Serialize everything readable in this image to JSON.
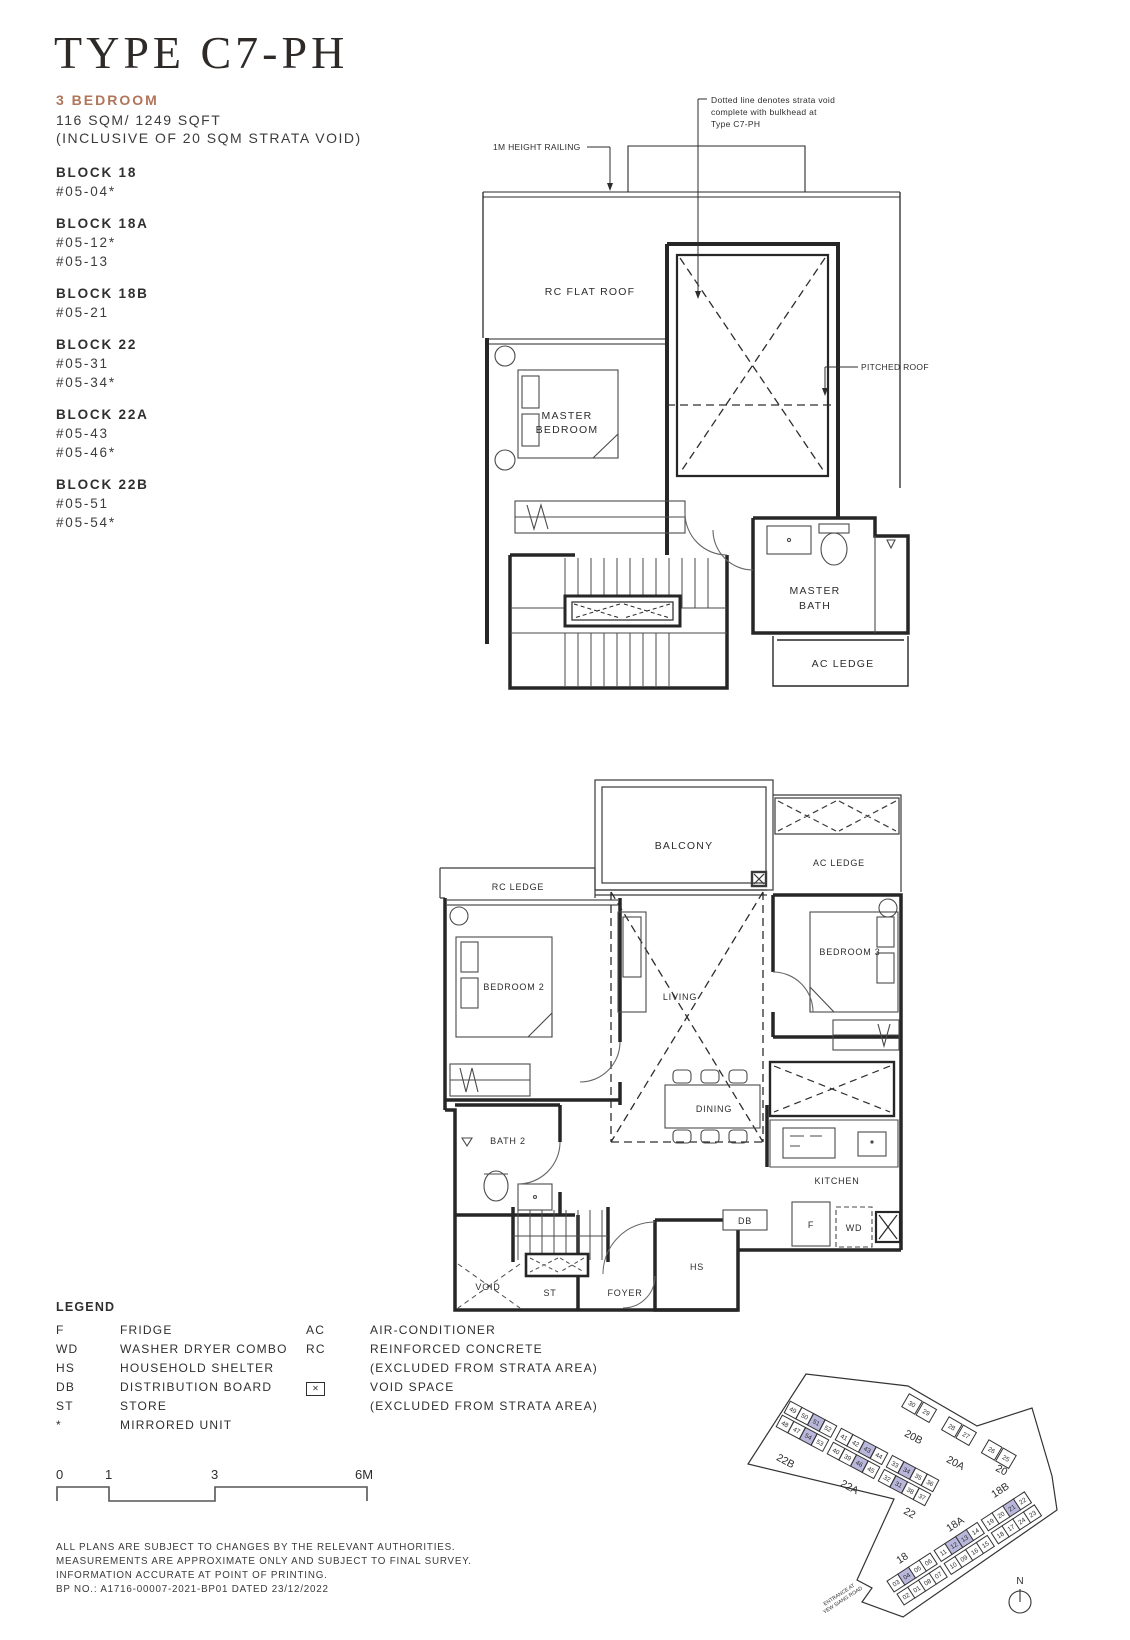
{
  "header": {
    "title": "TYPE C7-PH",
    "unit_type": "3 BEDROOM",
    "area": "116 SQM/ 1249 SQFT",
    "area_note": "(INCLUSIVE OF 20 SQM STRATA VOID)",
    "accent_color": "#b1755a"
  },
  "blocks": [
    {
      "name": "BLOCK 18",
      "units": [
        "#05-04*"
      ]
    },
    {
      "name": "BLOCK 18A",
      "units": [
        "#05-12*",
        "#05-13"
      ]
    },
    {
      "name": "BLOCK 18B",
      "units": [
        "#05-21"
      ]
    },
    {
      "name": "BLOCK 22",
      "units": [
        "#05-31",
        "#05-34*"
      ]
    },
    {
      "name": "BLOCK 22A",
      "units": [
        "#05-43",
        "#05-46*"
      ]
    },
    {
      "name": "BLOCK 22B",
      "units": [
        "#05-51",
        "#05-54*"
      ]
    }
  ],
  "upper_plan": {
    "rooms": {
      "rc_flat_roof": "RC FLAT ROOF",
      "master_bedroom_1": "MASTER",
      "master_bedroom_2": "BEDROOM",
      "master_bath_1": "MASTER",
      "master_bath_2": "BATH",
      "ac_ledge": "AC LEDGE"
    },
    "annotations": {
      "railing": "1M HEIGHT RAILING",
      "strata_1": "Dotted line denotes strata void",
      "strata_2": "complete with bulkhead at",
      "strata_3": "Type C7-PH",
      "pitched_roof": "PITCHED ROOF"
    }
  },
  "lower_plan": {
    "rooms": {
      "balcony": "BALCONY",
      "ac_ledge": "AC LEDGE",
      "rc_ledge": "RC LEDGE",
      "bedroom2": "BEDROOM 2",
      "living": "LIVING",
      "bedroom3": "BEDROOM 3",
      "dining": "DINING",
      "bath2": "BATH 2",
      "kitchen": "KITCHEN",
      "db": "DB",
      "fridge": "F",
      "wd": "WD",
      "foyer": "FOYER",
      "hs": "HS",
      "void": "VOID",
      "st": "ST"
    }
  },
  "legend": {
    "title": "LEGEND",
    "void_symbol": "✕",
    "left": [
      {
        "abbr": "F",
        "label": "FRIDGE"
      },
      {
        "abbr": "WD",
        "label": "WASHER DRYER COMBO"
      },
      {
        "abbr": "HS",
        "label": "HOUSEHOLD SHELTER"
      },
      {
        "abbr": "DB",
        "label": "DISTRIBUTION BOARD"
      },
      {
        "abbr": "ST",
        "label": "STORE"
      },
      {
        "abbr": "*",
        "label": "MIRRORED UNIT"
      }
    ],
    "right": [
      {
        "abbr": "AC",
        "label": "AIR-CONDITIONER"
      },
      {
        "abbr": "RC",
        "label": "REINFORCED CONCRETE"
      },
      {
        "abbr": "",
        "label": "(EXCLUDED FROM STRATA AREA)"
      },
      {
        "abbr": "",
        "label": "VOID SPACE"
      },
      {
        "abbr": "",
        "label": "(EXCLUDED FROM STRATA AREA)"
      }
    ]
  },
  "scale": {
    "ticks": [
      "0",
      "1",
      "3",
      "6M"
    ]
  },
  "notes": [
    "ALL PLANS ARE SUBJECT TO CHANGES BY THE RELEVANT AUTHORITIES.",
    "MEASUREMENTS ARE APPROXIMATE ONLY AND SUBJECT TO FINAL SURVEY.",
    "INFORMATION ACCURATE AT POINT OF PRINTING.",
    "BP NO.: A1716-00007-2021-BP01 DATED 23/12/2022"
  ],
  "site_plan": {
    "north_label": "N",
    "entrance_line1": "ENTRANCE AT",
    "entrance_line2": "YEW SIANG ROAD",
    "highlight_color": "#b9b7db",
    "highlighted_units": [
      "04",
      "12",
      "13",
      "21",
      "31",
      "34",
      "43",
      "46",
      "51",
      "54"
    ],
    "strips": [
      {
        "angle": 28,
        "x": 93,
        "y": 80,
        "step": 13.2,
        "size": 13,
        "row_dx": -8,
        "row_dy": 14,
        "gaps": [
          3,
          7
        ],
        "gap": 5,
        "rows": [
          [
            {
              "n": "49"
            },
            {
              "n": "50"
            },
            {
              "n": "51",
              "h": true
            },
            {
              "n": "52"
            },
            {
              "n": "41"
            },
            {
              "n": "42"
            },
            {
              "n": "43",
              "h": true
            },
            {
              "n": "44"
            },
            {
              "n": "33"
            },
            {
              "n": "34",
              "h": true
            },
            {
              "n": "35"
            },
            {
              "n": "36"
            }
          ],
          [
            {
              "n": "48"
            },
            {
              "n": "47"
            },
            {
              "n": "54",
              "h": true
            },
            {
              "n": "53"
            },
            {
              "n": "40"
            },
            {
              "n": "39"
            },
            {
              "n": "46",
              "h": true
            },
            {
              "n": "45"
            },
            {
              "n": "32"
            },
            {
              "n": "31",
              "h": true
            },
            {
              "n": "38"
            },
            {
              "n": "37"
            }
          ]
        ]
      },
      {
        "angle": 30,
        "x": 212,
        "y": 74,
        "step": 16.5,
        "size": 15,
        "row_dx": 0,
        "row_dy": 0,
        "gaps": [
          1,
          3
        ],
        "gap": 13,
        "rows": [
          [
            {
              "n": "30"
            },
            {
              "n": "29"
            },
            {
              "n": "28"
            },
            {
              "n": "27"
            },
            {
              "n": "26"
            },
            {
              "n": "25"
            }
          ]
        ]
      },
      {
        "angle": -33,
        "x": 196,
        "y": 253,
        "step": 12.8,
        "size": 13,
        "row_dx": 10,
        "row_dy": 13,
        "gaps": [
          3,
          7
        ],
        "gap": 5,
        "rows": [
          [
            {
              "n": "03"
            },
            {
              "n": "04",
              "h": true
            },
            {
              "n": "05"
            },
            {
              "n": "06"
            },
            {
              "n": "11"
            },
            {
              "n": "12",
              "h": true
            },
            {
              "n": "13",
              "h": true
            },
            {
              "n": "14"
            },
            {
              "n": "19"
            },
            {
              "n": "20"
            },
            {
              "n": "21",
              "h": true
            },
            {
              "n": "22"
            }
          ],
          [
            {
              "n": "02"
            },
            {
              "n": "01"
            },
            {
              "n": "08"
            },
            {
              "n": "07"
            },
            {
              "n": "10"
            },
            {
              "n": "09"
            },
            {
              "n": "16"
            },
            {
              "n": "15"
            },
            {
              "n": "18"
            },
            {
              "n": "17"
            },
            {
              "n": "24"
            },
            {
              "n": "23"
            }
          ]
        ]
      }
    ],
    "block_labels": [
      {
        "t": "22B",
        "x": 84,
        "y": 134,
        "r": 28
      },
      {
        "t": "22A",
        "x": 148,
        "y": 160,
        "r": 28
      },
      {
        "t": "22",
        "x": 208,
        "y": 186,
        "r": 28
      },
      {
        "t": "20B",
        "x": 212,
        "y": 110,
        "r": 28
      },
      {
        "t": "20A",
        "x": 254,
        "y": 136,
        "r": 28
      },
      {
        "t": "20",
        "x": 300,
        "y": 143,
        "r": 28
      },
      {
        "t": "18B",
        "x": 302,
        "y": 163,
        "r": -33
      },
      {
        "t": "18A",
        "x": 257,
        "y": 197,
        "r": -33
      },
      {
        "t": "18",
        "x": 204,
        "y": 231,
        "r": -33
      }
    ]
  }
}
